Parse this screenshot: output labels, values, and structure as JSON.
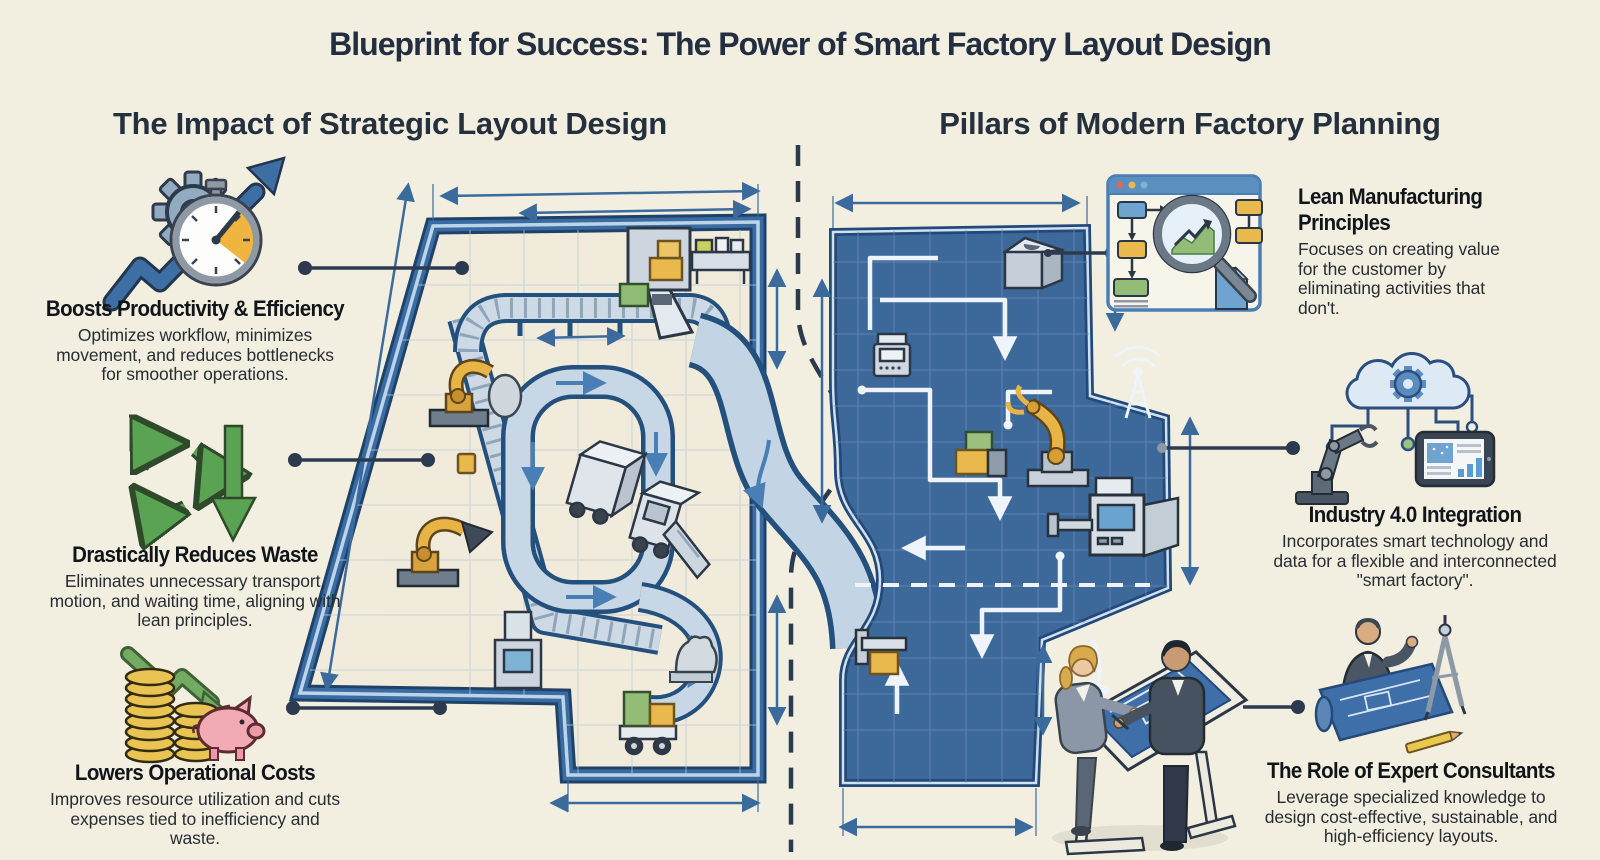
{
  "title": "Blueprint for Success: The Power of Smart Factory Layout Design",
  "left_section": {
    "heading": "The Impact of Strategic Layout Design",
    "items": [
      {
        "icon": "gear-stopwatch-growth-arrow-icon",
        "title": "Boosts Productivity & Efficiency",
        "description": "Optimizes workflow, minimizes movement, and reduces bottlenecks for smoother operations."
      },
      {
        "icon": "recycle-down-arrow-icon",
        "title": "Drastically Reduces Waste",
        "description": "Eliminates unnecessary transport, motion, and waiting time, aligning with lean principles."
      },
      {
        "icon": "coins-piggy-bank-down-arrow-icon",
        "title": "Lowers Operational Costs",
        "description": "Improves resource utilization and cuts expenses tied to inefficiency and waste."
      }
    ]
  },
  "right_section": {
    "heading": "Pillars of Modern Factory Planning",
    "items": [
      {
        "icon": "process-analysis-magnifier-window-icon",
        "title": "Lean Manufacturing Principles",
        "description": "Focuses on creating value for the customer by eliminating activities that don't."
      },
      {
        "icon": "cloud-gear-robot-tablet-icon",
        "title": "Industry 4.0 Integration",
        "description": "Incorporates smart technology and data for a flexible and interconnected \"smart factory\"."
      },
      {
        "icon": "consultant-blueprint-compass-icon",
        "title": "The Role of Expert Consultants",
        "description": "Leverage specialized knowledge to design cost-effective, sustainable, and high-efficiency layouts."
      }
    ]
  },
  "illustration": {
    "left_factory": "floor-plan-with-conveyors-robots-trucks",
    "right_factory": "blueprint-flow-diagram-with-robot-machines",
    "planners": "two-engineers-at-drafting-table"
  },
  "colors": {
    "background": "#f2efe1",
    "heading_text": "#25303f",
    "blueprint_blue": "#3d689a",
    "wall_blue": "#2d5e94",
    "conveyor_light": "#c7d7e5",
    "accent_yellow": "#e9b94e",
    "accent_green": "#5aa352",
    "coin_gold": "#e9c452",
    "piggy_pink": "#f2abb4",
    "callout_line": "#2c3a4f"
  }
}
